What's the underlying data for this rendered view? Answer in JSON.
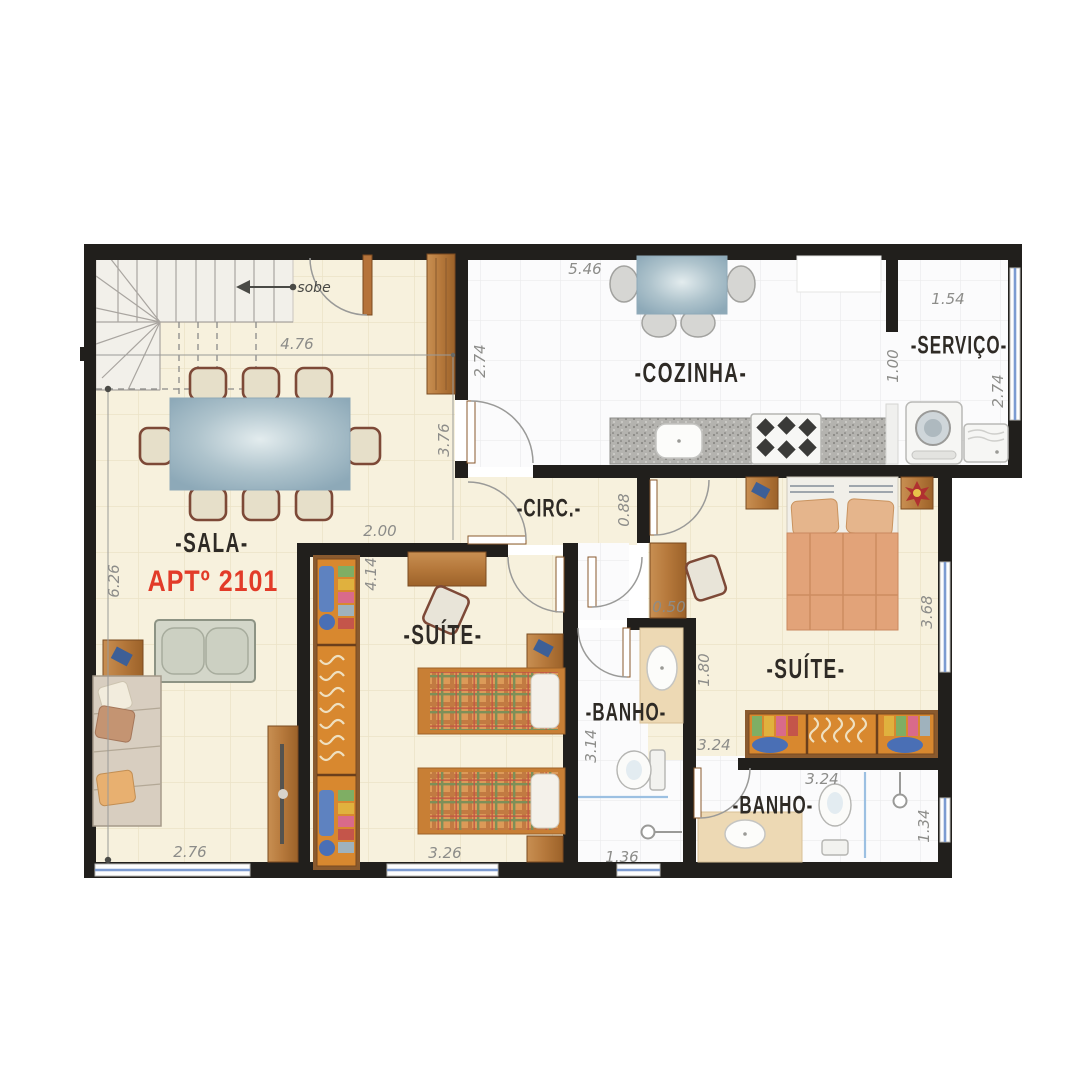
{
  "plan": {
    "apartment_number": "APTº 2101",
    "stairs": {
      "direction_label": "sobe"
    },
    "rooms": {
      "sala": {
        "label": "-SALA-"
      },
      "cozinha": {
        "label": "-COZINHA-"
      },
      "servico": {
        "label": "-SERVIÇO-"
      },
      "circ": {
        "label": "-CIRC.-"
      },
      "suite1": {
        "label": "-SUÍTE-"
      },
      "suite2": {
        "label": "-SUÍTE-"
      },
      "banho1": {
        "label": "-BANHO-"
      },
      "banho2": {
        "label": "-BANHO-"
      }
    },
    "dimensions": {
      "sala_top_width": "4.76",
      "sala_right_height": "3.76",
      "sala_left_height": "6.26",
      "sala_bottom_width": "2.76",
      "suite1_top_width": "2.00",
      "cozinha_top_width": "5.46",
      "cozinha_left_height": "2.74",
      "cozinha_right_height": "1.00",
      "servico_top_width": "1.54",
      "servico_left_height": "1.00",
      "servico_right_height": "2.74",
      "circ_height": "0.88",
      "suite1_left_height": "4.14",
      "suite1_bottom_width": "3.26",
      "suite2_desk_depth": "0.50",
      "suite2_left_height": "1.80",
      "suite2_right_height": "3.68",
      "suite2_bottom_width": "3.24",
      "banho1_left_height": "3.14",
      "banho1_bottom_width": "1.36",
      "banho2_top_width": "3.24",
      "banho2_right_height": "1.34"
    },
    "colors": {
      "wall": "#211f1c",
      "floor_cream": "#f7f1dd",
      "floor_white": "#fbfbfc",
      "window_blue": "#7c9bd1",
      "wood": "#bb7c40",
      "wardrobe_orange": "#d8882f",
      "apartment_label_red": "#e23b28",
      "table_blue": "#9db9c6",
      "bed_salmon": "#e2a379"
    }
  }
}
